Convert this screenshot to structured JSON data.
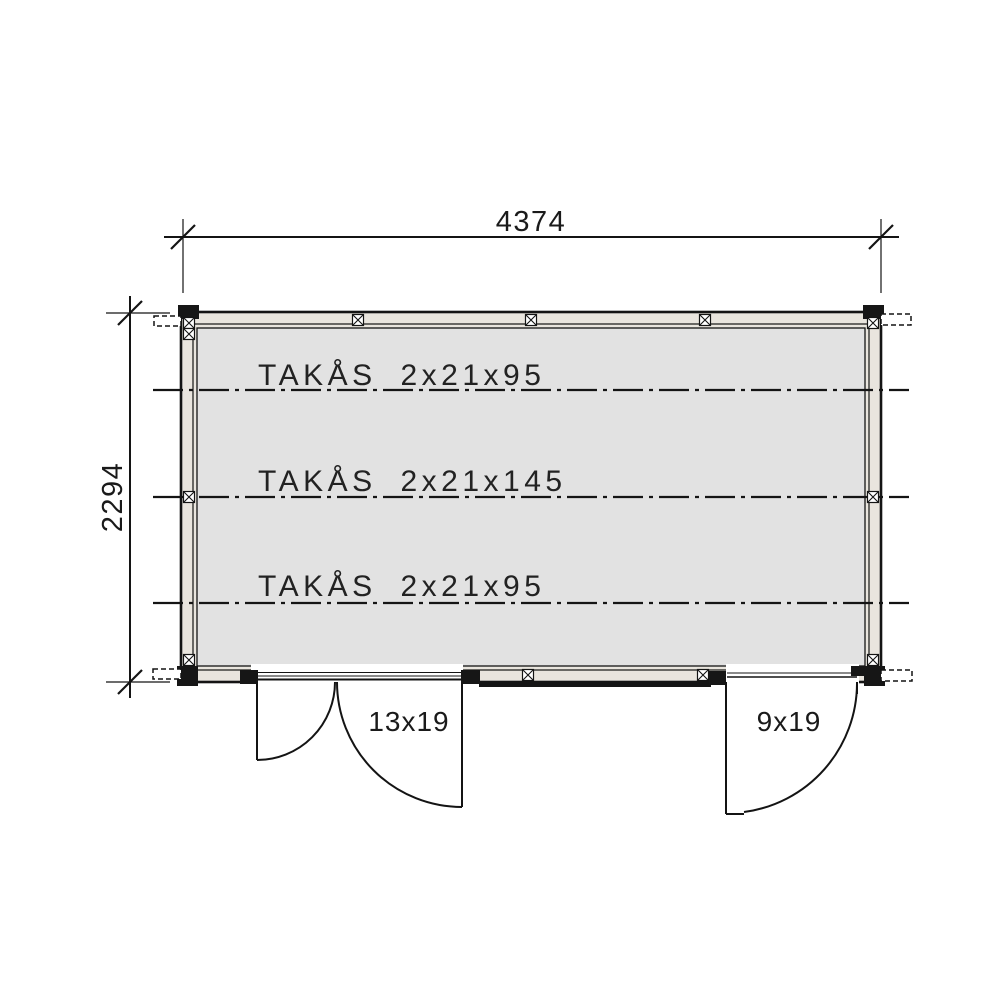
{
  "drawing": {
    "type": "floor-plan",
    "dim_width": "4374",
    "dim_height": "2294",
    "purlins": [
      {
        "label": "TAKÅS 2x21x95"
      },
      {
        "label": "TAKÅS 2x21x145"
      },
      {
        "label": "TAKÅS 2x21x95"
      }
    ],
    "doors": [
      {
        "label": "13x19",
        "type": "double"
      },
      {
        "label": "9x19",
        "type": "single"
      }
    ],
    "colors": {
      "floor": "#e2e2e2",
      "wall": "#e9e5de",
      "line": "#141414"
    }
  }
}
